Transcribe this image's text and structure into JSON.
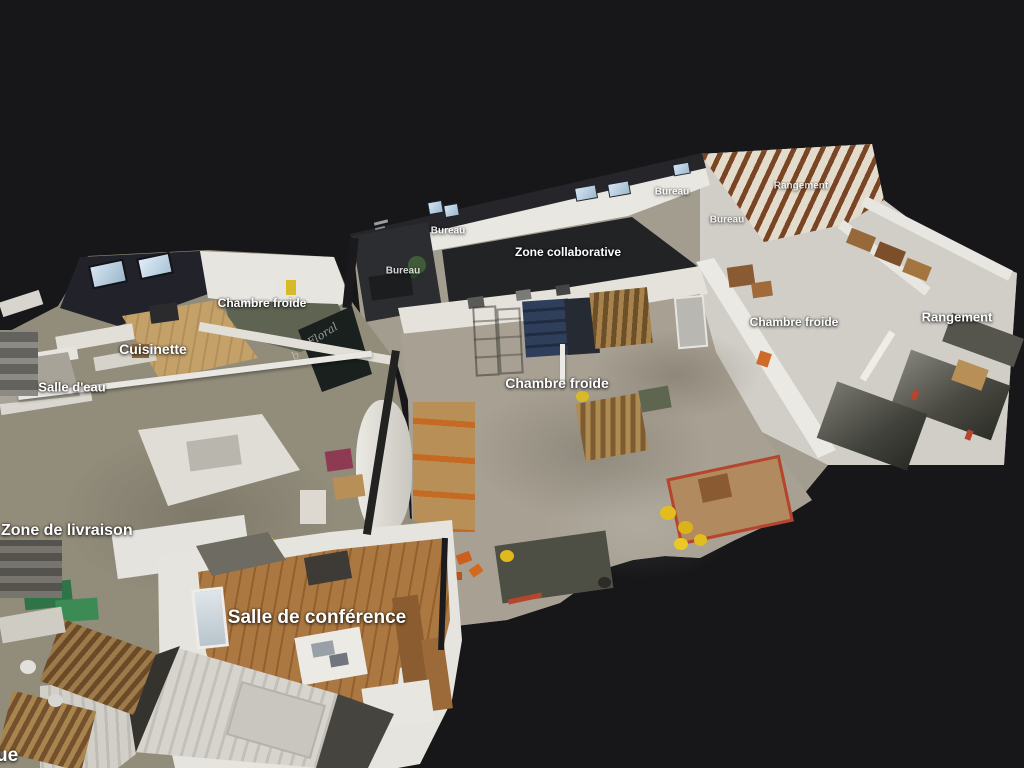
{
  "viewer": {
    "description": "3D dollhouse overhead view of a commercial building interior",
    "background_color": "#17171a",
    "label_color": "#ffffff"
  },
  "room_labels": [
    {
      "text": "Bureau"
    },
    {
      "text": "Rangement"
    },
    {
      "text": "Bureau"
    },
    {
      "text": "Zone collaborative"
    },
    {
      "text": "Bureau"
    },
    {
      "text": "Bureau"
    },
    {
      "text": "Chambre froide"
    },
    {
      "text": "Cuisinette"
    },
    {
      "text": "Salle d'eau"
    },
    {
      "text": "Chambre froide"
    },
    {
      "text": "Chambre froide"
    },
    {
      "text": "Rangement"
    },
    {
      "text": "Zone de livraison"
    },
    {
      "text": "Salle de conférence"
    },
    {
      "text": "ue"
    }
  ],
  "chalkboard": {
    "text": "Floral",
    "partial": "b"
  }
}
